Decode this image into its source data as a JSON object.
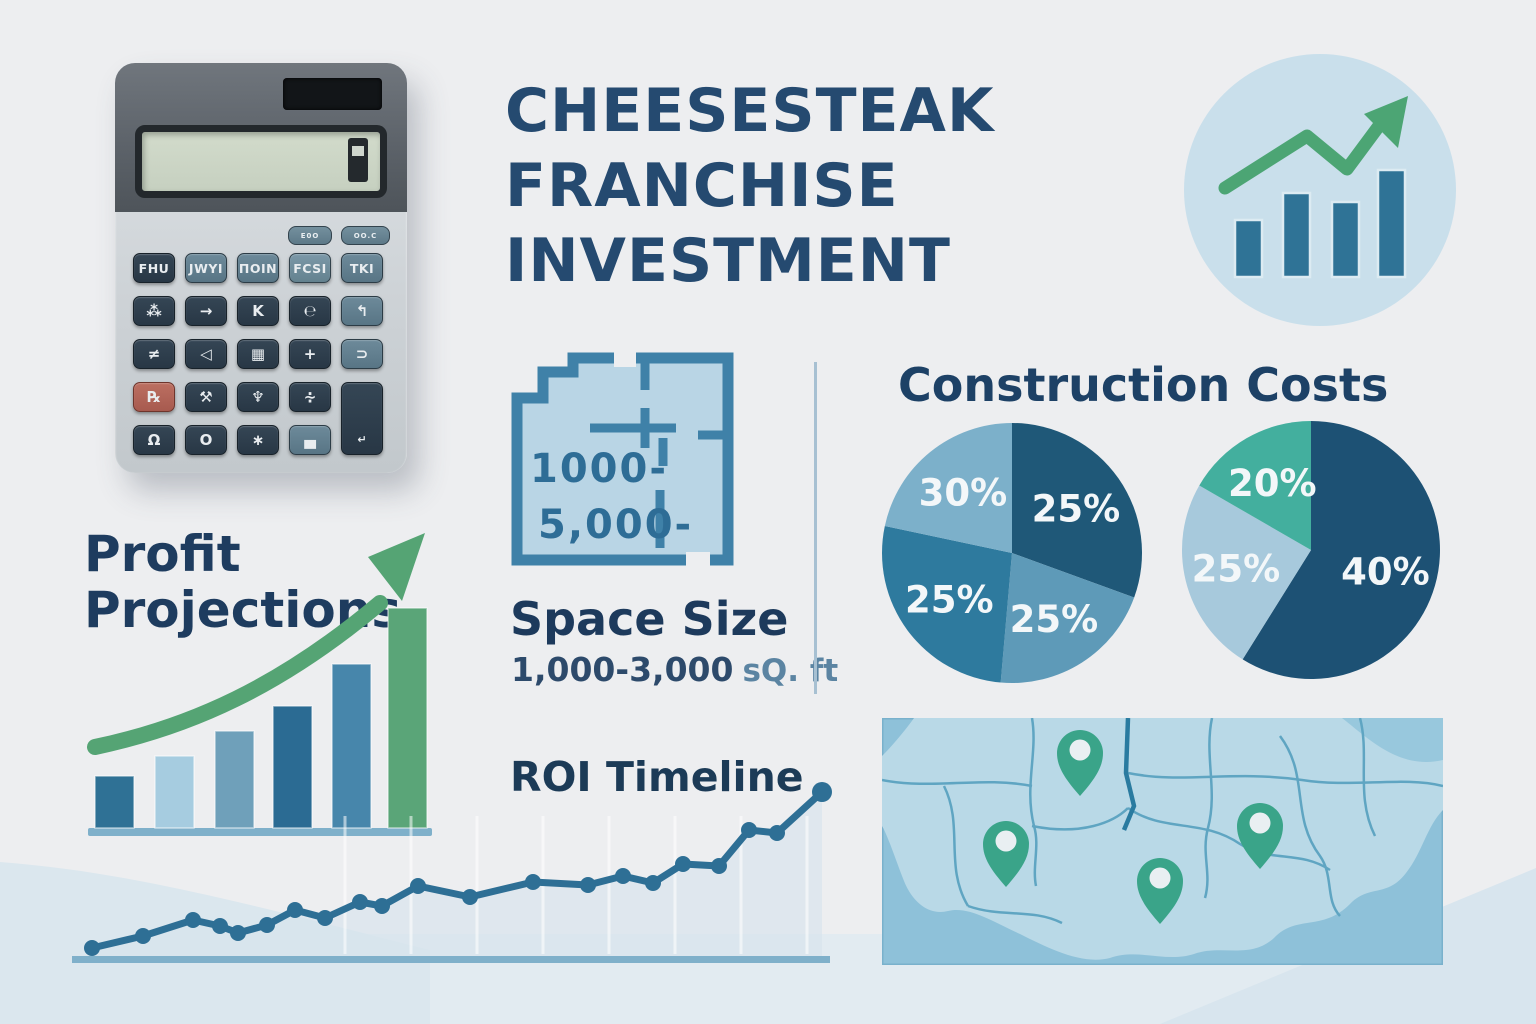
{
  "title": {
    "line1": "CHEESESTEAK",
    "line2": "FRANCHISE",
    "line3": "INVESTMENT"
  },
  "sections": {
    "profit": {
      "heading_line1": "Profit",
      "heading_line2": "Projections"
    },
    "space": {
      "plan_label_line1": "1000-",
      "plan_label_line2": "5,000-",
      "heading": "Space Size",
      "range_value": "1,000-3,000",
      "range_unit": "sQ. ft"
    },
    "construction": {
      "heading": "Construction Costs"
    },
    "roi": {
      "heading": "ROI Timeline"
    }
  },
  "calculator": {
    "small_buttons": [
      {
        "label": "E0O"
      },
      {
        "label": "OO.C"
      }
    ],
    "buttons": [
      [
        {
          "label": "FHU",
          "style": "dark txt"
        },
        {
          "label": "JWYI",
          "style": "teal txt"
        },
        {
          "label": "ΠOIN",
          "style": "teal txt"
        },
        {
          "label": "FCSI",
          "style": "teal-light txt"
        },
        {
          "label": "TKI",
          "style": "teal txt"
        }
      ],
      [
        {
          "label": "⁂",
          "style": "dark"
        },
        {
          "label": "→",
          "style": "dark"
        },
        {
          "label": "K",
          "style": "dark"
        },
        {
          "label": "℮",
          "style": "dark"
        },
        {
          "label": "↰",
          "style": "teal"
        }
      ],
      [
        {
          "label": "≠",
          "style": "dark"
        },
        {
          "label": "◁",
          "style": "dark"
        },
        {
          "label": "▦",
          "style": "dark"
        },
        {
          "label": "+",
          "style": "dark"
        },
        {
          "label": "⊃",
          "style": "teal"
        }
      ],
      [
        {
          "label": "℞",
          "style": "red"
        },
        {
          "label": "⚒",
          "style": "dark"
        },
        {
          "label": "♆",
          "style": "dark"
        },
        {
          "label": "∻",
          "style": "dark"
        },
        {
          "label": "↵",
          "style": "dark tall"
        }
      ],
      [
        {
          "label": "Ω",
          "style": "dark"
        },
        {
          "label": "O",
          "style": "dark"
        },
        {
          "label": "∗",
          "style": "dark"
        },
        {
          "label": "▄",
          "style": "teal"
        }
      ]
    ]
  },
  "chart_data": [
    {
      "id": "growth-circle-icon",
      "type": "bar",
      "title": "growth trend icon",
      "values": [
        57,
        84,
        75,
        107
      ],
      "bar_color": "#2f7396",
      "line_color": "#4ca574",
      "trend_points": [
        [
          45,
          138
        ],
        [
          127,
          86
        ],
        [
          167,
          119
        ],
        [
          207,
          65
        ]
      ],
      "arrow": [
        [
          184,
          64
        ],
        [
          228,
          46
        ],
        [
          218,
          98
        ]
      ],
      "circle_color": "#c9dfeb"
    },
    {
      "id": "profit-projections",
      "type": "bar",
      "title": "Profit Projections",
      "categories": [],
      "values": [
        52,
        72,
        97,
        122,
        164,
        220
      ],
      "colors": [
        "#2f7195",
        "#a6cce0",
        "#6fa0ba",
        "#2b6b93",
        "#4786ab",
        "#5aa578"
      ],
      "baseline_color": "#7fb0ca",
      "trend_arrow_color": "#55a474"
    },
    {
      "id": "construction-costs-pie-1",
      "type": "pie",
      "title": "Construction Costs",
      "slices": [
        {
          "label": "25%",
          "value": 25,
          "sweep": 110,
          "color": "#1f5878"
        },
        {
          "label": "25%",
          "value": 25,
          "sweep": 75,
          "color": "#5e9ab8"
        },
        {
          "label": "25%",
          "value": 25,
          "sweep": 97,
          "color": "#2e7a9e"
        },
        {
          "label": "30%",
          "value": 30,
          "sweep": 78,
          "color": "#7cb0ca"
        }
      ]
    },
    {
      "id": "construction-costs-pie-2",
      "type": "pie",
      "title": "Construction Costs",
      "slices": [
        {
          "label": "40%",
          "value": 40,
          "sweep": 212,
          "color": "#1d5174"
        },
        {
          "label": "25%",
          "value": 25,
          "sweep": 88,
          "color": "#a7c9dc"
        },
        {
          "label": "20%",
          "value": 20,
          "sweep": 60,
          "color": "#43af9e"
        }
      ]
    },
    {
      "id": "roi-timeline",
      "type": "line",
      "title": "ROI Timeline",
      "line_color": "#2e6f95",
      "baseline_color": "#7fb0ca",
      "fill_color": "#d7e3ec",
      "points": [
        [
          0,
          10
        ],
        [
          51,
          22
        ],
        [
          101,
          38
        ],
        [
          128,
          32
        ],
        [
          146,
          25
        ],
        [
          175,
          33
        ],
        [
          203,
          48
        ],
        [
          233,
          40
        ],
        [
          268,
          56
        ],
        [
          290,
          52
        ],
        [
          326,
          72
        ],
        [
          378,
          61
        ],
        [
          441,
          76
        ],
        [
          496,
          73
        ],
        [
          531,
          82
        ],
        [
          561,
          75
        ],
        [
          591,
          94
        ],
        [
          627,
          92
        ],
        [
          657,
          128
        ],
        [
          685,
          125
        ],
        [
          730,
          166
        ]
      ]
    }
  ],
  "map": {
    "pin_color": "#3aa489",
    "pin_inner_color": "#e9eff2",
    "pins": [
      {
        "x": 198,
        "y": 34
      },
      {
        "x": 124,
        "y": 125
      },
      {
        "x": 278,
        "y": 162
      },
      {
        "x": 378,
        "y": 107
      }
    ]
  },
  "colors": {
    "background": "#edeef0",
    "title_navy": "#254a70",
    "heading_navy": "#1e3c5f",
    "accent_green": "#55a474",
    "accent_blue": "#2e6f95",
    "map_water": "#8ec1d9",
    "map_land": "#b9d9e7"
  }
}
